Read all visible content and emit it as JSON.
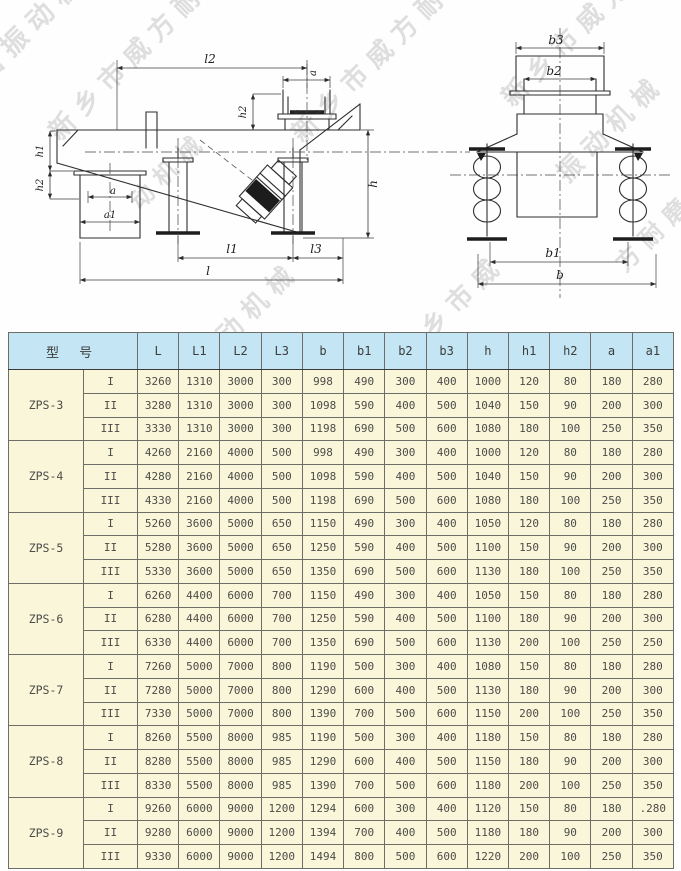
{
  "watermark": {
    "color": "#c9c9c9",
    "instances": [
      {
        "text": "磨振动机械",
        "x": -22,
        "y": 56,
        "size": 27
      },
      {
        "text": "新乡市威方耐磨",
        "x": 52,
        "y": 116,
        "size": 26
      },
      {
        "text": "新乡市威方耐磨",
        "x": 295,
        "y": 118,
        "size": 26
      },
      {
        "text": "新乡市威方",
        "x": 505,
        "y": 82,
        "size": 26
      },
      {
        "text": "振动机械",
        "x": 560,
        "y": 158,
        "size": 26
      },
      {
        "text": "动机械",
        "x": 132,
        "y": 186,
        "size": 24
      },
      {
        "text": "振动机械",
        "x": 195,
        "y": 345,
        "size": 26
      },
      {
        "text": "新乡市威",
        "x": 400,
        "y": 338,
        "size": 26
      },
      {
        "text": "方耐磨振",
        "x": 618,
        "y": 248,
        "size": 24
      }
    ]
  },
  "drawing": {
    "labels": {
      "l2": "l2",
      "a_inlet": "a",
      "h2_inlet": "h2",
      "h1_left": "h1",
      "h2_left": "h2",
      "a_outlet": "a",
      "a1_outlet": "a1",
      "h_right": "h",
      "l1": "l1",
      "l3": "l3",
      "l": "l",
      "b3": "b3",
      "b2": "b2",
      "b1": "b1",
      "b": "b"
    }
  },
  "table": {
    "header_model": "型 号",
    "columns": [
      "L",
      "L1",
      "L2",
      "L3",
      "b",
      "b1",
      "b2",
      "b3",
      "h",
      "h1",
      "h2",
      "a",
      "a1"
    ],
    "colors": {
      "header_bg": "#c3e5f4",
      "body_bg": "#faf6da",
      "border": "#6e6e68"
    },
    "groups": [
      {
        "model": "ZPS-3",
        "rows": [
          {
            "tier": "I",
            "values": [
              "3260",
              "1310",
              "3000",
              "300",
              "998",
              "490",
              "300",
              "400",
              "1000",
              "120",
              "80",
              "180",
              "280"
            ]
          },
          {
            "tier": "II",
            "values": [
              "3280",
              "1310",
              "3000",
              "300",
              "1098",
              "590",
              "400",
              "500",
              "1040",
              "150",
              "90",
              "200",
              "300"
            ]
          },
          {
            "tier": "III",
            "values": [
              "3330",
              "1310",
              "3000",
              "300",
              "1198",
              "690",
              "500",
              "600",
              "1080",
              "180",
              "100",
              "250",
              "350"
            ]
          }
        ]
      },
      {
        "model": "ZPS-4",
        "rows": [
          {
            "tier": "I",
            "values": [
              "4260",
              "2160",
              "4000",
              "500",
              "998",
              "490",
              "300",
              "400",
              "1000",
              "120",
              "80",
              "180",
              "280"
            ]
          },
          {
            "tier": "II",
            "values": [
              "4280",
              "2160",
              "4000",
              "500",
              "1098",
              "590",
              "400",
              "500",
              "1040",
              "150",
              "90",
              "200",
              "300"
            ]
          },
          {
            "tier": "III",
            "values": [
              "4330",
              "2160",
              "4000",
              "500",
              "1198",
              "690",
              "500",
              "600",
              "1080",
              "180",
              "100",
              "250",
              "350"
            ]
          }
        ]
      },
      {
        "model": "ZPS-5",
        "rows": [
          {
            "tier": "I",
            "values": [
              "5260",
              "3600",
              "5000",
              "650",
              "1150",
              "490",
              "300",
              "400",
              "1050",
              "120",
              "80",
              "180",
              "280"
            ]
          },
          {
            "tier": "II",
            "values": [
              "5280",
              "3600",
              "5000",
              "650",
              "1250",
              "590",
              "400",
              "500",
              "1100",
              "150",
              "90",
              "200",
              "300"
            ]
          },
          {
            "tier": "III",
            "values": [
              "5330",
              "3600",
              "5000",
              "650",
              "1350",
              "690",
              "500",
              "600",
              "1130",
              "180",
              "100",
              "250",
              "350"
            ]
          }
        ]
      },
      {
        "model": "ZPS-6",
        "rows": [
          {
            "tier": "I",
            "values": [
              "6260",
              "4400",
              "6000",
              "700",
              "1150",
              "490",
              "300",
              "400",
              "1050",
              "150",
              "80",
              "180",
              "280"
            ]
          },
          {
            "tier": "II",
            "values": [
              "6280",
              "4400",
              "6000",
              "700",
              "1250",
              "590",
              "400",
              "500",
              "1100",
              "180",
              "90",
              "200",
              "300"
            ]
          },
          {
            "tier": "III",
            "values": [
              "6330",
              "4400",
              "6000",
              "700",
              "1350",
              "690",
              "500",
              "600",
              "1130",
              "200",
              "100",
              "250",
              "250"
            ]
          }
        ]
      },
      {
        "model": "ZPS-7",
        "rows": [
          {
            "tier": "I",
            "values": [
              "7260",
              "5000",
              "7000",
              "800",
              "1190",
              "500",
              "300",
              "400",
              "1080",
              "150",
              "80",
              "180",
              "280"
            ]
          },
          {
            "tier": "II",
            "values": [
              "7280",
              "5000",
              "7000",
              "800",
              "1290",
              "600",
              "400",
              "500",
              "1130",
              "180",
              "90",
              "200",
              "300"
            ]
          },
          {
            "tier": "III",
            "values": [
              "7330",
              "5000",
              "7000",
              "800",
              "1390",
              "700",
              "500",
              "600",
              "1150",
              "200",
              "100",
              "250",
              "350"
            ]
          }
        ]
      },
      {
        "model": "ZPS-8",
        "rows": [
          {
            "tier": "I",
            "values": [
              "8260",
              "5500",
              "8000",
              "985",
              "1190",
              "500",
              "300",
              "400",
              "1180",
              "150",
              "80",
              "180",
              "280"
            ]
          },
          {
            "tier": "II",
            "values": [
              "8280",
              "5500",
              "8000",
              "985",
              "1290",
              "600",
              "400",
              "500",
              "1150",
              "180",
              "90",
              "200",
              "300"
            ]
          },
          {
            "tier": "III",
            "values": [
              "8330",
              "5500",
              "8000",
              "985",
              "1390",
              "700",
              "500",
              "600",
              "1180",
              "200",
              "100",
              "250",
              "350"
            ]
          }
        ]
      },
      {
        "model": "ZPS-9",
        "rows": [
          {
            "tier": "I",
            "values": [
              "9260",
              "6000",
              "9000",
              "1200",
              "1294",
              "600",
              "300",
              "400",
              "1120",
              "150",
              "80",
              "180",
              ".280"
            ]
          },
          {
            "tier": "II",
            "values": [
              "9280",
              "6000",
              "9000",
              "1200",
              "1394",
              "700",
              "400",
              "500",
              "1180",
              "180",
              "90",
              "200",
              "300"
            ]
          },
          {
            "tier": "III",
            "values": [
              "9330",
              "6000",
              "9000",
              "1200",
              "1494",
              "800",
              "500",
              "600",
              "1220",
              "200",
              "100",
              "250",
              "350"
            ]
          }
        ]
      }
    ]
  }
}
